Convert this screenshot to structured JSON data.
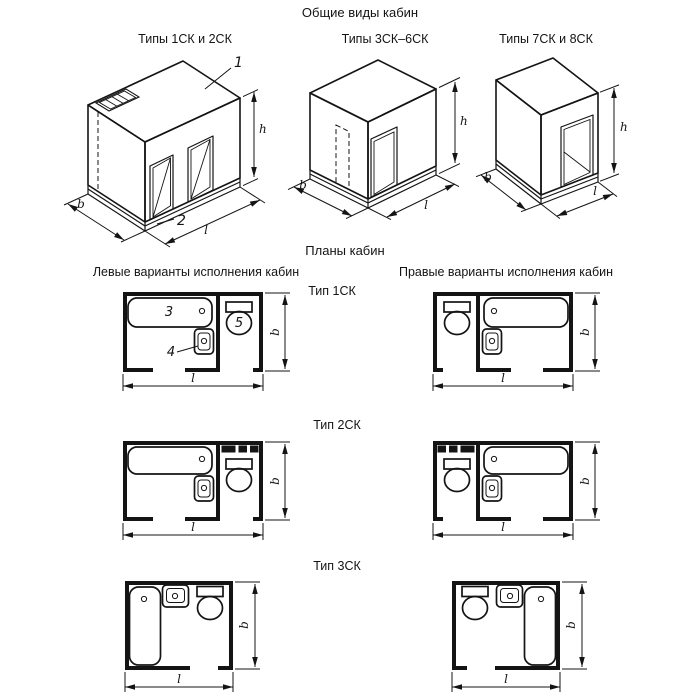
{
  "header": {
    "title": "Общие виды кабин"
  },
  "views": {
    "view1": {
      "label": "Типы 1СК и 2СК"
    },
    "view2": {
      "label": "Типы 3СК–6СК"
    },
    "view3": {
      "label": "Типы 7СК и 8СК"
    }
  },
  "plans": {
    "title": "Планы кабин",
    "left_heading": "Левые варианты исполнения кабин",
    "right_heading": "Правые варианты исполнения кабин",
    "type1": {
      "label": "Тип 1СК"
    },
    "type2": {
      "label": "Тип 2СК"
    },
    "type3": {
      "label": "Тип 3СК"
    }
  },
  "dims": {
    "b": "b",
    "l": "l",
    "h": "h"
  },
  "callouts": {
    "c1": "1",
    "c2": "2",
    "c3": "3",
    "c4": "4",
    "c5": "5"
  }
}
